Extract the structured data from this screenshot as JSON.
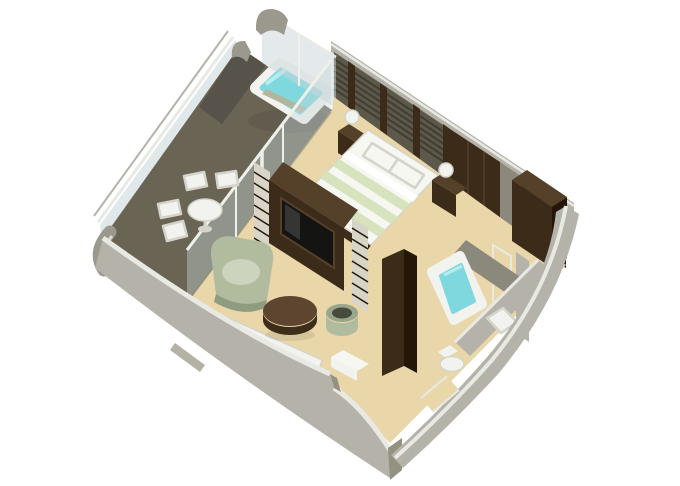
{
  "title": "isometric-suite-floorplan-rendering",
  "colors": {
    "background": "#ffffff",
    "deck": "#6a6454",
    "deck_dark": "#57534a",
    "floor_tan": "#e9d6a9",
    "wall_outer": "#b5b3a9",
    "wall_outer_dark": "#93917f",
    "wall_top": "#e9e9e4",
    "wall_inner_olive": "#5c594a",
    "wall_stripe": "#403e33",
    "wall_gray_panel": "#8b887c",
    "slat_light": "#d8d5c8",
    "wood_dark": "#3c2b19",
    "wood_darker": "#241708",
    "wood_mid": "#55402a",
    "tv_black": "#141412",
    "glass": "#c9d6d8",
    "glass_frame": "#eef0ea",
    "railing_gray": "#9b998e",
    "water": "#7fd8de",
    "water_light": "#b8ebec",
    "fixture_white": "#f2f3ee",
    "fixture_shadow": "#d4d4ca",
    "linen_white": "#f6f7f1",
    "linen_green": "#d7e3bd",
    "sage": "#b1bc9e",
    "sage_light": "#cdd4bd",
    "sage_dark": "#8f9c80",
    "table_wood": "#5d452f",
    "table_wood_dark": "#3f2d1c",
    "stool_rim": "#9aa68c",
    "stool_top": "#474b3c",
    "bench_tan": "#b5b49a"
  },
  "scene": {
    "kind": "3d-isometric-cutaway-suite-floorplan",
    "rooms": [
      {
        "name": "balcony",
        "features": [
          "whirlpool-tub",
          "dining-table",
          "four-chairs",
          "glass-railing",
          "glass-windbreak"
        ]
      },
      {
        "name": "bedroom",
        "features": [
          "double-bed",
          "pillows",
          "nightstand-left",
          "nightstand-right",
          "sphere-lamps",
          "louvered-headboard-wall"
        ]
      },
      {
        "name": "living-room",
        "features": [
          "white-sofa",
          "sage-armchair",
          "round-coffee-table",
          "round-stool",
          "tv-media-wall",
          "slatted-screens",
          "white-sideboard"
        ]
      },
      {
        "name": "bathroom",
        "features": [
          "bathtub",
          "sink",
          "toilet",
          "dark-partition-wall"
        ]
      },
      {
        "name": "dressing-area",
        "features": [
          "wardrobes",
          "open-door-panel"
        ]
      },
      {
        "name": "entry-foyer",
        "features": [
          "door-gap"
        ]
      }
    ]
  }
}
